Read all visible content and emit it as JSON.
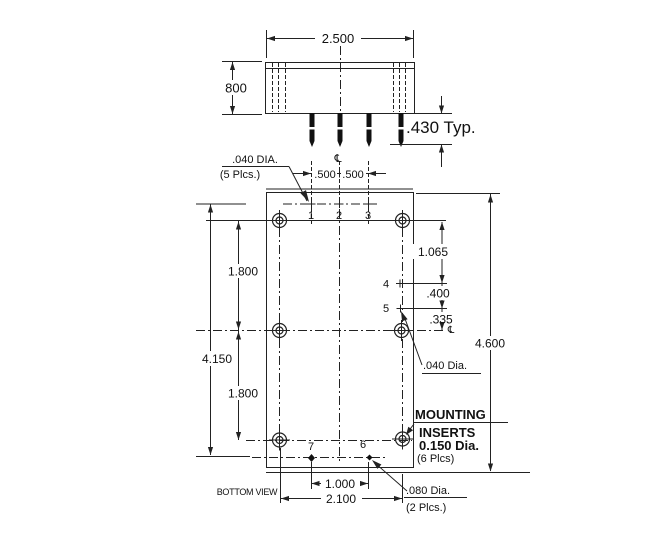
{
  "colors": {
    "ink": "#222222",
    "background": "#ffffff"
  },
  "top_view": {
    "width": "2.500",
    "height": "800",
    "pin_length": ".430 Typ."
  },
  "bottom_view": {
    "view_label": "BOTTOM VIEW",
    "centerline_symbol": "℄",
    "pin_dia": {
      "label": ".040 DIA.",
      "places": "(5 Plcs.)"
    },
    "pin5_dia": {
      "label": ".040 Dia."
    },
    "bottom_pins_dia": {
      "label": ".080 Dia.",
      "places": "(2 Plcs.)"
    },
    "mounting_inserts": {
      "line1": "MOUNTING",
      "line2": "INSERTS",
      "line3": "0.150 Dia.",
      "line4": "(6 Plcs)"
    },
    "dims": {
      "pin_spacing_left": ".500",
      "pin_spacing_right": ".500",
      "hole_to_pin4": "1.065",
      "pin4_to_pin5": ".400",
      "pin5_to_center": ".335",
      "overall_height": "4.600",
      "hole_span_upper": "1.800",
      "pin_row_span": "4.150",
      "hole_span_lower": "1.800",
      "pin6_to_pin7": "1.000",
      "hole_span_width": "2.100"
    },
    "pins": {
      "p1": "1",
      "p2": "2",
      "p3": "3",
      "p4": "4",
      "p5": "5",
      "p6": "6",
      "p7": "7"
    }
  }
}
